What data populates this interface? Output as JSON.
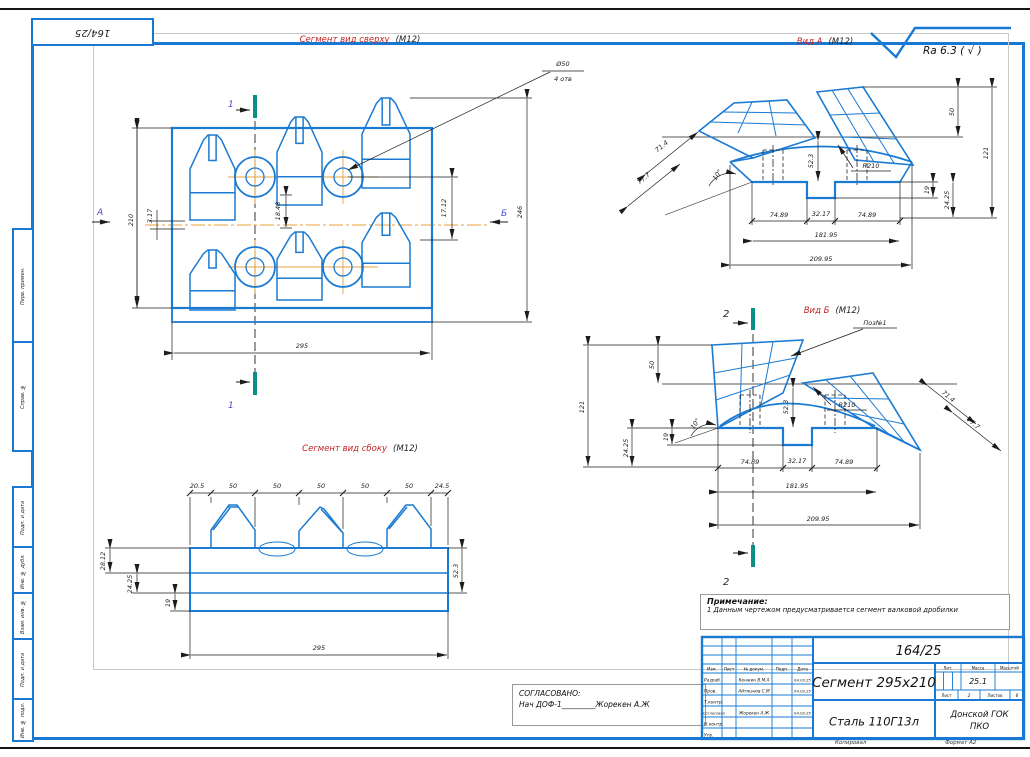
{
  "colors": {
    "line_blue": "#1b7ad2",
    "frame_blue": "#1878d2",
    "dim_black": "#1c1c1c",
    "centerline_orange": "#e8a23c",
    "section_teal": "#0a9186",
    "title_red": "#c52222",
    "label_blue": "#4a4ad0"
  },
  "doc": {
    "number": "164/25",
    "copied_label": "Копировал",
    "format_label": "Формат А2"
  },
  "titles": {
    "top_view": "Сегмент вид сверху",
    "top_view_scale": "(М12)",
    "side_view": "Сегмент вид сбоку",
    "side_view_scale": "(М12)",
    "view_a": "Вид А",
    "view_a_scale": "(М12)",
    "view_b": "Вид Б",
    "view_b_scale": "(М12)"
  },
  "roughness": {
    "value": "Ra 6.3 ( √ )"
  },
  "top_view": {
    "label_a": "А",
    "label_b": "Б",
    "section_label": "1",
    "hole_dia": "Ø50",
    "hole_qty": "4 отв",
    "dims": {
      "d210": "210",
      "d317": "3.17",
      "d1848": "18.48",
      "d1712": "17.12",
      "d246": "246",
      "d295": "295"
    }
  },
  "view_a": {
    "dims": {
      "d50": "50",
      "d121": "121",
      "d714": "71.4",
      "d777": "77.7",
      "d523": "52.3",
      "r210": "R210",
      "angle": "10°",
      "d19": "19",
      "d2425": "24.25",
      "seg_a": "74.89",
      "seg_b": "32.17",
      "seg_c": "74.89",
      "span": "181.95",
      "total": "209.95"
    }
  },
  "view_b": {
    "section_label": "2",
    "pos_label": "Поз№1",
    "dims": {
      "d50": "50",
      "d121": "121",
      "d714": "71.4",
      "d777": "77.7",
      "d523": "52.3",
      "r210": "R210",
      "angle": "10°",
      "d19": "19",
      "d2425": "24.25",
      "seg_a": "74.89",
      "seg_b": "32.17",
      "seg_c": "74.89",
      "span": "181.95",
      "total": "209.95"
    }
  },
  "side_view": {
    "dims": {
      "d205": "20.5",
      "pitch": "50",
      "d245": "24.5",
      "d2812": "28.12",
      "d2425": "24.25",
      "d19": "19",
      "d523": "52.3",
      "d295": "295"
    }
  },
  "note": {
    "heading": "Примечание:",
    "text": "1 Данным чертежом предусматривается сегмент валковой дробилки"
  },
  "approval": {
    "heading": "СОГЛАСОВАНО:",
    "text": "Нач ДОФ-1_________Жорекен А.Ж"
  },
  "stamp": {
    "cols": {
      "izm": "Изм.",
      "list": "Лист",
      "doc": "№ докум.",
      "podp": "Подп.",
      "data": "Дата"
    },
    "rows": [
      {
        "role": "Разраб.",
        "name": "Кенжин В.М.А",
        "date": "04.03.25"
      },
      {
        "role": "Пров.",
        "name": "Айтжанов С.М",
        "date": "04.03.25"
      },
      {
        "role": "Т.контр.",
        "name": "",
        "date": ""
      },
      {
        "role": "Согласовал",
        "name": "Жорекен А.Ж",
        "date": "04.03.25"
      },
      {
        "role": "Н.контр.",
        "name": "",
        "date": ""
      },
      {
        "role": "Утв.",
        "name": "",
        "date": ""
      }
    ],
    "doc_number": "164/25",
    "part_title": "Сегмент 295х210",
    "material": "Сталь 110Г13л",
    "lit_label": "Лит.",
    "mass_label": "Масса",
    "scale_label": "Масштаб",
    "mass_value": "25.1",
    "sheet_label": "Лист",
    "sheet_value": "2",
    "sheets_label": "Листов",
    "sheets_value": "6",
    "org_line1": "Донской ГОК",
    "org_line2": "ПКО"
  },
  "margin": {
    "perv": "Перв. примен.",
    "sprav": "Справ. №",
    "podp_data1": "Подп. и дата",
    "inv_dubl": "Инв. № дубл.",
    "vzam": "Взам. инв. №",
    "podp_data2": "Подп. и дата",
    "inv_podl": "Инв. № подл."
  }
}
